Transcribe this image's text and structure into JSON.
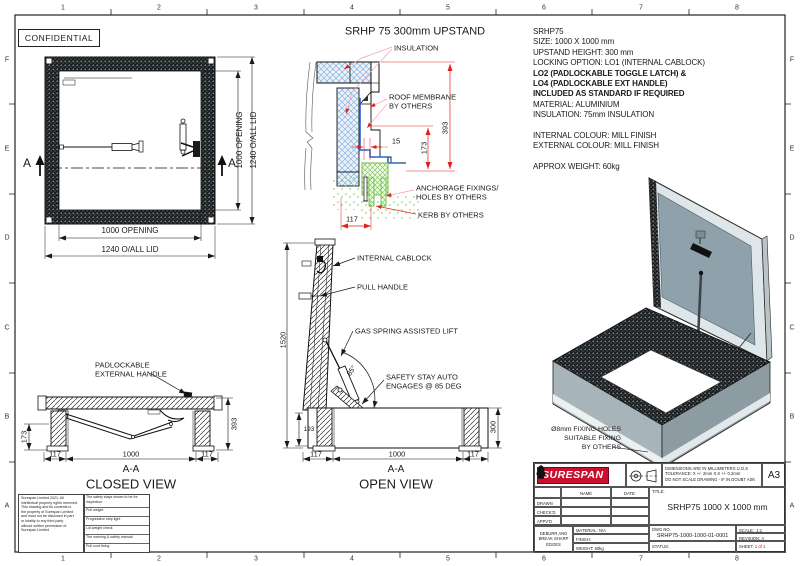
{
  "frame": {
    "cols": [
      "1",
      "2",
      "3",
      "4",
      "5",
      "6",
      "7",
      "8"
    ],
    "rows": [
      "F",
      "E",
      "D",
      "C",
      "B",
      "A"
    ]
  },
  "confidential_label": "CONFIDENTIAL",
  "plan_view": {
    "dim_opening": "1000 OPENING",
    "dim_overall": "1240 O/ALL LID",
    "section_letter": "A"
  },
  "upstand_section": {
    "title": "SRHP 75 300mm UPSTAND",
    "label_insulation": "INSULATION",
    "label_membrane_1": "ROOF MEMBRANE",
    "label_membrane_2": "BY OTHERS",
    "label_anchorage_1": "ANCHORAGE FIXINGS/",
    "label_anchorage_2": "HOLES BY OTHERS",
    "label_kerb": "KERB BY OTHERS",
    "dim_overall_height": "393",
    "dim_inner_height": "173",
    "dim_liner_gap": "15",
    "dim_kerb_width": "117"
  },
  "spec": {
    "lines": [
      "SRHP75",
      "SIZE: 1000 X 1000 mm",
      "UPSTAND HEIGHT: 300 mm",
      "LOCKING OPTION: LO1 (INTERNAL CABLOCK)",
      "LO2 (PADLOCKABLE TOGGLE LATCH) &",
      "LO4 (PADLOCKABLE EXT HANDLE)",
      "INCLUDED AS STANDARD IF REQUIRED",
      "MATERIAL: ALUMINIUM",
      "INSULATION: 75mm INSULATION",
      "",
      "INTERNAL COLOUR: MILL FINISH",
      "EXTERNAL COLOUR: MILL FINISH",
      "",
      "APPROX WEIGHT: 60kg"
    ]
  },
  "closed_view": {
    "label_handle_1": "PADLOCKABLE",
    "label_handle_2": "EXTERNAL HANDLE",
    "dim_frame_height": "173",
    "dim_overall_height": "393",
    "dim_left": "117",
    "dim_opening": "1000",
    "dim_right": "117",
    "section_ref": "A-A",
    "caption": "CLOSED VIEW"
  },
  "open_view": {
    "label_cablock": "INTERNAL CABLOCK",
    "label_handle": "PULL HANDLE",
    "label_spring": "GAS SPRING ASSISTED LIFT",
    "label_stay_1": "SAFETY STAY AUTO",
    "label_stay_2": "ENGAGES @ 85 DEG",
    "angle": "85°",
    "dim_open_height": "1520",
    "dim_lid": "193",
    "dim_upstand": "300",
    "dim_left": "117",
    "dim_opening": "1000",
    "dim_right": "117",
    "section_ref": "A-A",
    "caption": "OPEN VIEW"
  },
  "iso_view": {
    "label_fixing_1": "Ø8mm FIXING HOLES",
    "label_fixing_2": "SUITABLE FIXING",
    "label_fixing_3": "BY OTHERS"
  },
  "title_block": {
    "logo": "SURESPAN",
    "notes": [
      "DIMENSIONS ARE IN MILLIMETERS U.O.S",
      "TOLERANCE: X +/- 2mm  X.X +/- 0.2mm",
      "DO NOT SCALE DRAWING - IF IN DOUBT ASK"
    ],
    "sheet_size": "A3",
    "col_name": "NAME",
    "col_date": "DATE:",
    "row_drawn": "DRAWN",
    "row_checked": "CHECK'D",
    "row_approved": "APPV'D",
    "deburr": [
      "DEBURR AND",
      "BREAK SHARP",
      "EDGES"
    ],
    "material_label": "MATERIAL:",
    "material_value": "N/A",
    "finish_label": "FINISH:",
    "weight_label": "WEIGHT:",
    "weight_value": "60kg",
    "title_label": "TITLE:",
    "title": "SRHP75 1000 X 1000 mm",
    "dwg_label": "DWG NO.",
    "dwg_no": "SRHP75-1000-1000-01-0001",
    "scale_label": "SCALE:",
    "scale_value": "1:1",
    "revision_label": "REVISION:",
    "revision_value": "A",
    "status_label": "STATUS:",
    "sheet_label": "SHEET:",
    "sheet_value": "1 of 1"
  },
  "fine_print": {
    "copyright": [
      "Surespan Limited 2021. All",
      "intellectual property rights reserved.",
      "This drawing and its contents is",
      "the property of Surespan Limited",
      "and must not be disclosed in part",
      "or totality to any third party",
      "without written permission of",
      "Surespan Limited"
    ],
    "checklist": [
      "The safety stays shown to be for inspection",
      "Pull weight",
      "Progressive strip light",
      "Lid weight check",
      "The warning & safety manual",
      "Pull cord fixing"
    ]
  },
  "colors": {
    "dim_red": "#e02020",
    "leader_pink": "#f2a0b8",
    "insulation_blue": "#79a8d6",
    "kerb_green": "#72bf44",
    "logo_red": "#c8102e",
    "sheet_red": "#cc0000"
  }
}
